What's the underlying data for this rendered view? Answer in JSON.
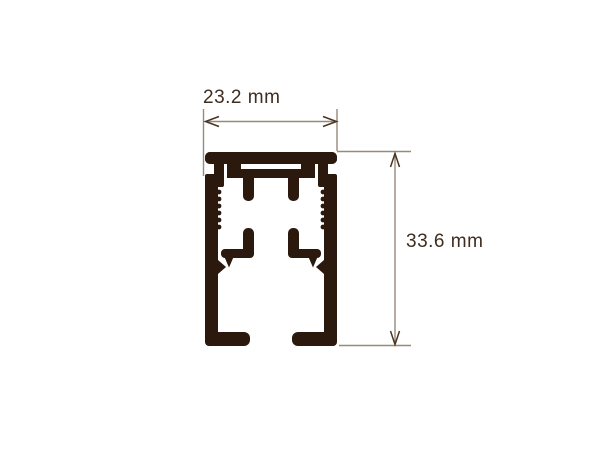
{
  "diagram": {
    "type": "technical cross-section drawing",
    "subject": "extruded aluminium rail profile (cross-section) with dimension annotations",
    "dimensions": {
      "width_label": "23.2 mm",
      "height_label": "33.6 mm"
    },
    "colors": {
      "background": "#ffffff",
      "profile_fill": "#2b190e",
      "dimension_line": "#98897a",
      "arrow": "#4a3422",
      "text": "#3f2d1f"
    }
  }
}
